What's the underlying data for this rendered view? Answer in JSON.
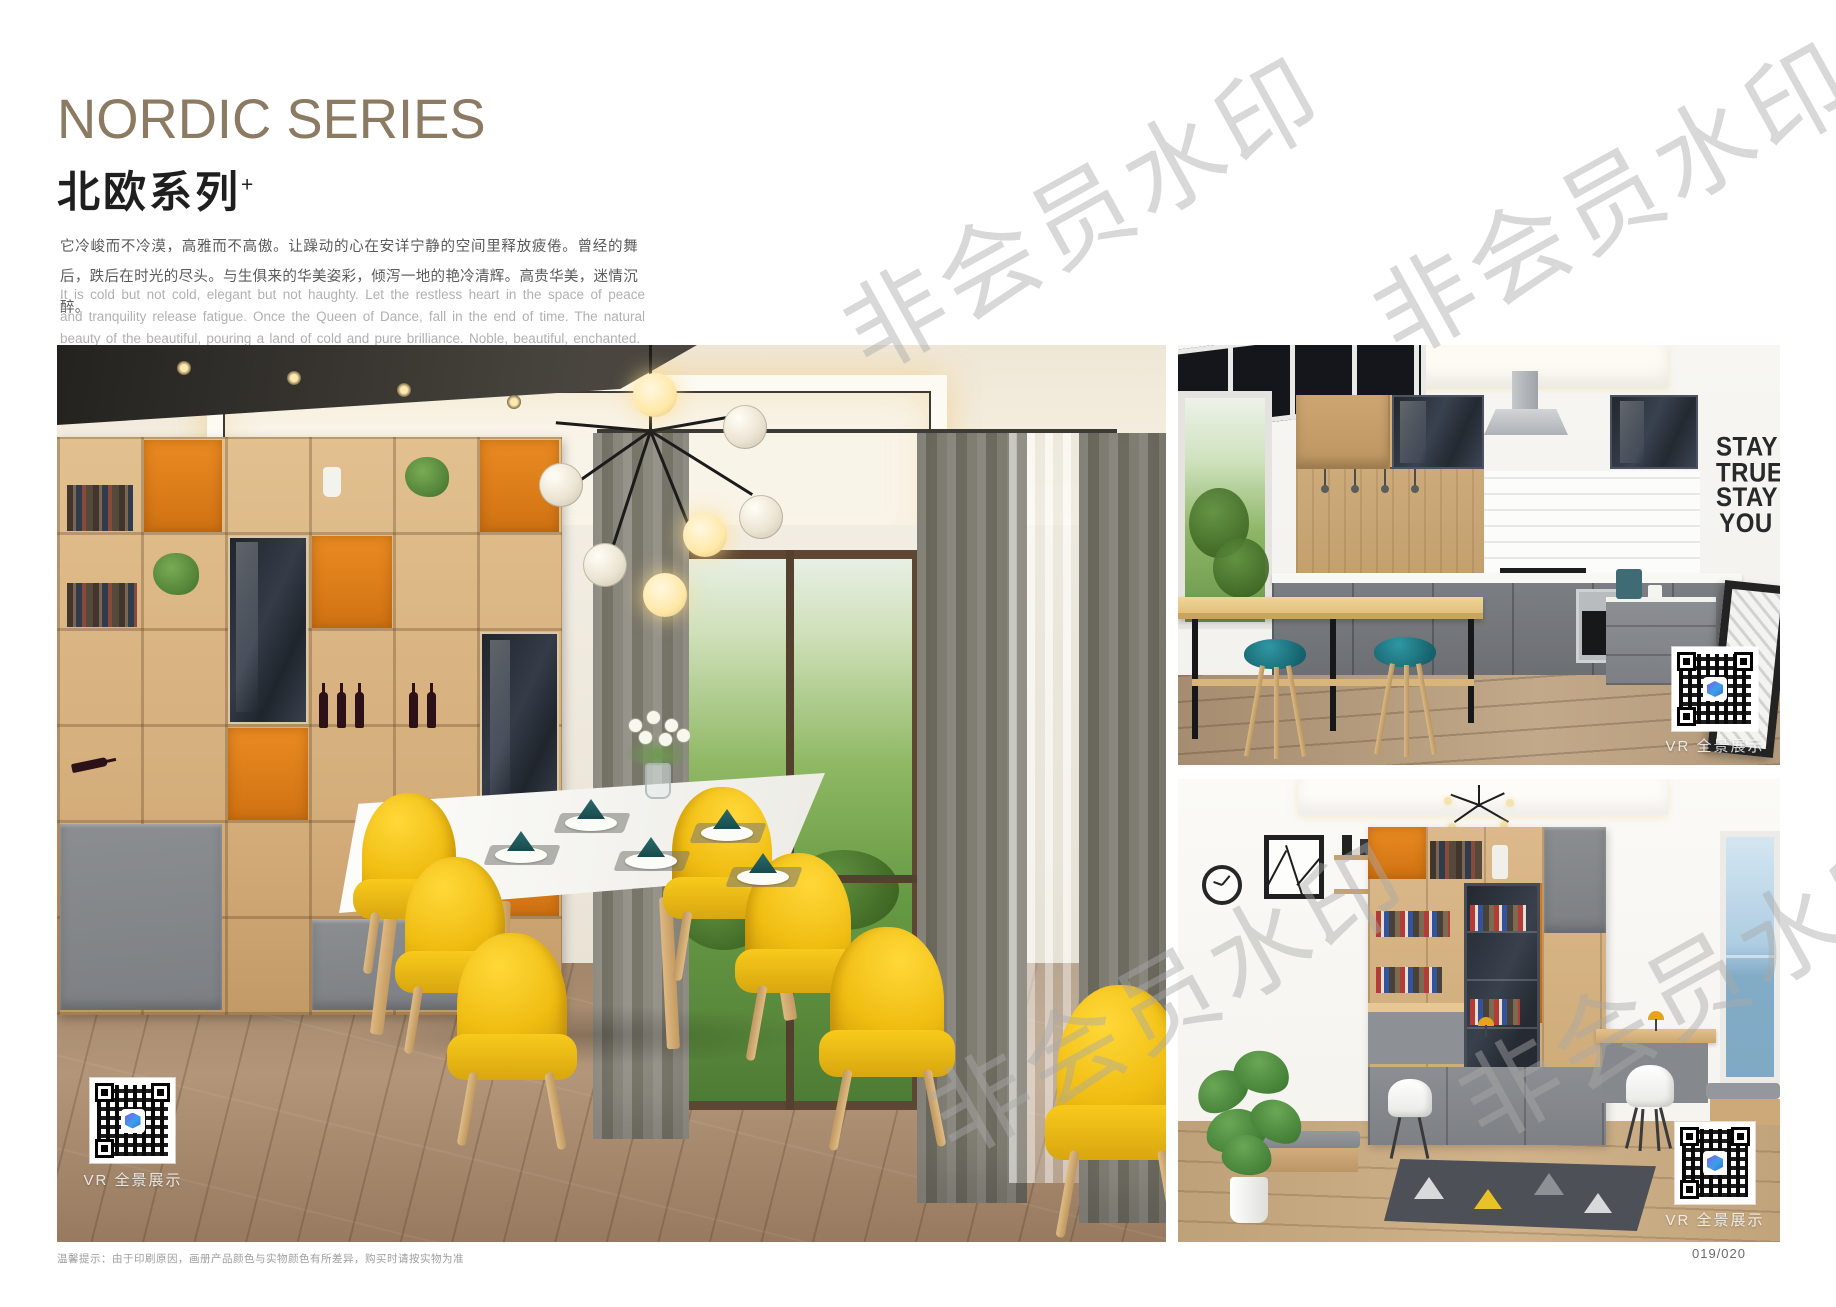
{
  "header": {
    "title_en": "NORDIC SERIES",
    "title_zh": "北欧系列",
    "title_sup": "+",
    "desc_zh": "它冷峻而不冷漠，高雅而不高傲。让躁动的心在安详宁静的空间里释放疲倦。曾经的舞后，跌后在时光的尽头。与生俱来的华美姿彩，倾泻一地的艳冷清辉。高贵华美，迷情沉醉。",
    "desc_en": "It is cold but not cold, elegant but not haughty. Let the restless heart in the space of peace and tranquility release fatigue. Once the Queen of Dance, fall in the end of time. The natural beauty of the beautiful, pouring a land of cold and pure brilliance. Noble, beautiful, enchanted."
  },
  "watermark": {
    "text": "非会员水印"
  },
  "photos": {
    "dining": {
      "vr_label": "VR 全景展示"
    },
    "kitchen": {
      "vr_label": "VR 全景展示",
      "wall_art": [
        "STAY",
        "TRUE",
        "STAY",
        "YOU"
      ]
    },
    "study": {
      "vr_label": "VR 全景展示"
    }
  },
  "footer": {
    "note": "温馨提示：由于印刷原因，画册产品颜色与实物颜色有所差异，购买时请按实物为准",
    "page_number": "019/020"
  },
  "colors": {
    "title_bronze": "#8C7B62",
    "accent_yellow": "#F2C113",
    "accent_orange": "#E0821F",
    "accent_teal": "#1D7B86",
    "wood": "#D5AF7F",
    "qr_logo_blue": "#3AA0E8"
  }
}
